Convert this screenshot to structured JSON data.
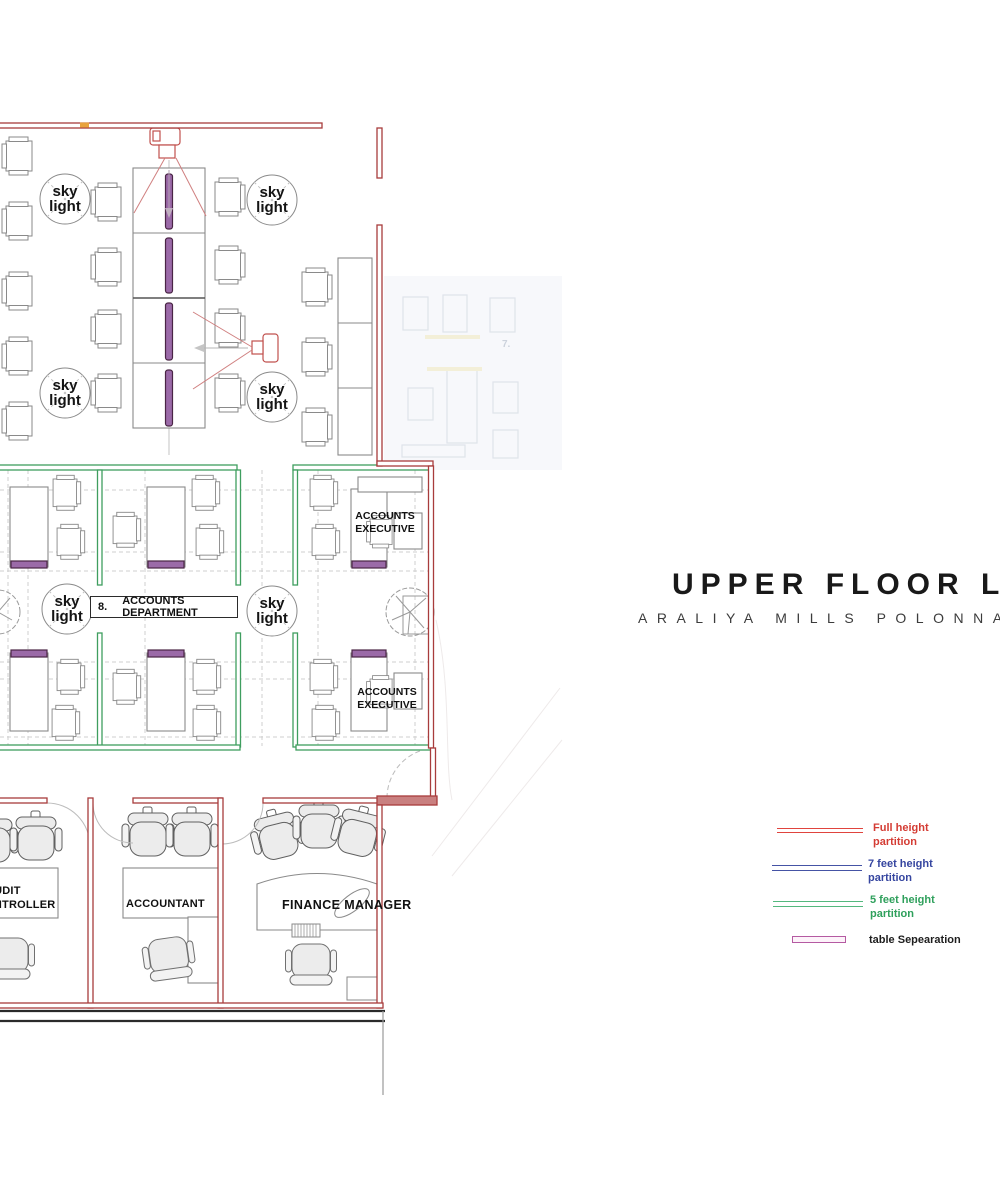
{
  "title": {
    "main": "UPPER FLOOR LAYOUT",
    "subtitle": "ARALIYA MILLS POLONNARUWA"
  },
  "plan": {
    "skylight": {
      "line1": "sky",
      "line2": "light"
    },
    "department_box": {
      "number": "8.",
      "name": "ACCOUNTS DEPARTMENT"
    },
    "accounts_executive": {
      "line1": "ACCOUNTS",
      "line2": "EXECUTIVE"
    },
    "rooms": {
      "audit_controller": {
        "line1": "AUDIT",
        "line2": "CONTROLLER"
      },
      "accountant": "ACCOUNTANT",
      "finance_manager": "FINANCE MANAGER"
    },
    "faded_zone_label": "7."
  },
  "legend": {
    "items": [
      {
        "line1": "Full  height",
        "line2": "partition",
        "color": "#d43c34"
      },
      {
        "line1": "7 feet height",
        "line2": "partition",
        "color": "#3646a0"
      },
      {
        "line1": "5 feet height",
        "line2": "partition",
        "color": "#2fa05c"
      },
      {
        "line1": "table Sepearation",
        "line2": "",
        "color": "#1e1e1e"
      }
    ]
  }
}
